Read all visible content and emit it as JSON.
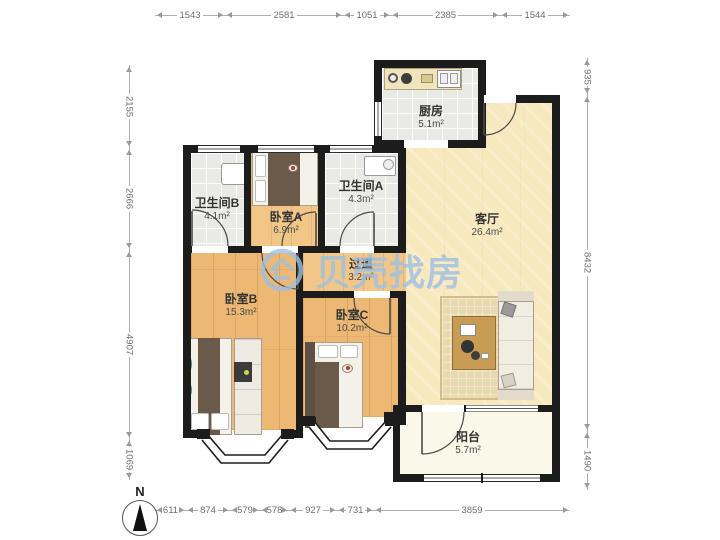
{
  "watermark": {
    "text": "贝壳找房",
    "color": "#9cc0e4"
  },
  "compass": {
    "label": "N"
  },
  "rooms": [
    {
      "id": "kitchen",
      "name": "厨房",
      "area": "5.1m²"
    },
    {
      "id": "bath-b",
      "name": "卫生间B",
      "area": "4.1m²"
    },
    {
      "id": "bedroom-a",
      "name": "卧室A",
      "area": "6.9m²"
    },
    {
      "id": "bath-a",
      "name": "卫生间A",
      "area": "4.3m²"
    },
    {
      "id": "living",
      "name": "客厅",
      "area": "26.4m²"
    },
    {
      "id": "hallway",
      "name": "过道",
      "area": "3.2m²"
    },
    {
      "id": "bedroom-b",
      "name": "卧室B",
      "area": "15.3m²"
    },
    {
      "id": "bedroom-c",
      "name": "卧室C",
      "area": "10.2m²"
    },
    {
      "id": "balcony",
      "name": "阳台",
      "area": "5.7m²"
    }
  ],
  "dimensions": {
    "top": [
      "1543",
      "2581",
      "1051",
      "2385",
      "1544"
    ],
    "left": [
      "2155",
      "2666",
      "4907",
      "1069"
    ],
    "right": [
      "935",
      "8432",
      "1490"
    ],
    "bottom": [
      "611",
      "874",
      "579",
      "578",
      "927",
      "731",
      "3859"
    ]
  },
  "colors": {
    "wall": "#1c1c1c",
    "wood_floor": "#ecb873",
    "living_floor": "#f7e8be",
    "tile_floor": "#e9e9e5",
    "balcony_floor": "#faf8e9",
    "watermark_blue": "#9cc0e4"
  }
}
